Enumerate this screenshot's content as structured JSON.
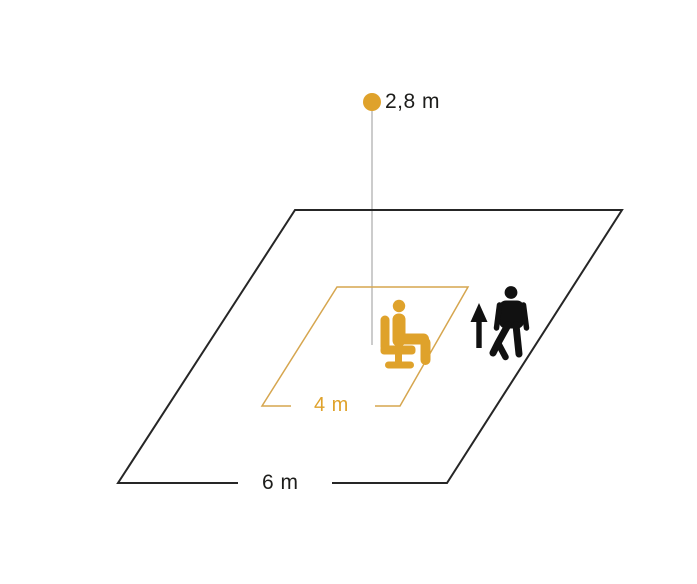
{
  "diagram": {
    "type": "sensor-detection-range-diagram",
    "labels": {
      "mounting_height": "2,8 m",
      "seated_range": "4 m",
      "walking_range": "6 m"
    },
    "colors": {
      "accent_orange": "#DFA22B",
      "zone_outline_orange": "#D6A64F",
      "outline_black": "#262626",
      "icon_black": "#111111",
      "text_dark": "#1D1D1B",
      "height_line_gray": "#ABABAB",
      "background": "#FFFFFF"
    },
    "icons": {
      "sensor": "sensor-dot-icon",
      "seated_person": "seated-person-icon",
      "walking_person": "walking-person-icon",
      "direction_arrow": "up-arrow-icon"
    }
  }
}
